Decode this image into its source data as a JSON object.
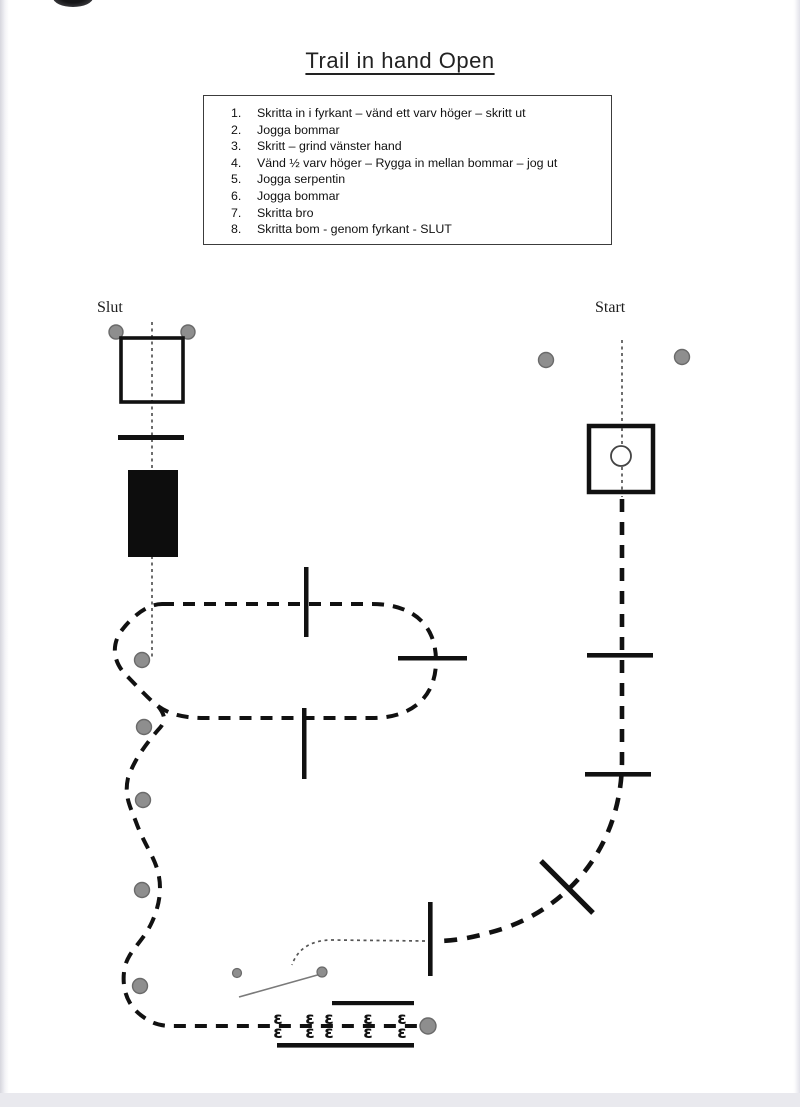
{
  "page": {
    "title": "Trail in hand Open"
  },
  "labels": {
    "finish": "Slut",
    "start": "Start"
  },
  "instructions": {
    "items": [
      {
        "num": "1.",
        "text": "Skritta in i fyrkant – vänd ett varv höger – skritt ut"
      },
      {
        "num": "2.",
        "text": "Jogga bommar"
      },
      {
        "num": "3.",
        "text": "Skritt – grind vänster hand"
      },
      {
        "num": "4.",
        "text": "Vänd ½ varv höger – Rygga in mellan bommar – jog ut"
      },
      {
        "num": "5.",
        "text": "Jogga serpentin"
      },
      {
        "num": "6.",
        "text": "Jogga bommar"
      },
      {
        "num": "7.",
        "text": "Skritta bro"
      },
      {
        "num": "8.",
        "text": "Skritta bom - genom fyrkant - SLUT"
      }
    ]
  },
  "diagram": {
    "hoofprint_glyph": "ɛ",
    "colors": {
      "line": "#111111",
      "walk_path": "#555555",
      "cone_fill": "#8e8e8e",
      "cone_border": "#6a6a6a",
      "gate_line": "#7a7a7a"
    }
  }
}
